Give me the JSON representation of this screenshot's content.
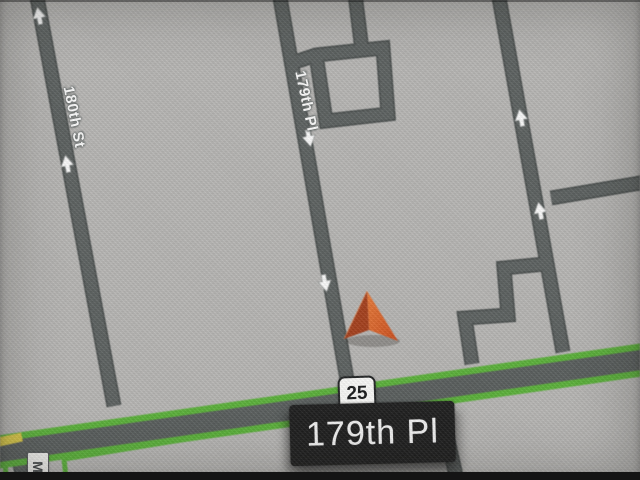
{
  "map": {
    "street_labels": {
      "street_180": "180th St",
      "street_179_vertical": "179th Pl",
      "street_m_partial": "M"
    },
    "route_shield_number": "25",
    "current_street_banner": "179th Pl",
    "oneway_arrows": [
      {
        "road": "180th St",
        "direction": "up"
      },
      {
        "road": "180th St",
        "direction": "up"
      },
      {
        "road": "179th Pl",
        "direction": "down"
      },
      {
        "road": "179th Pl",
        "direction": "down"
      },
      {
        "road": "right unnamed road",
        "direction": "up"
      },
      {
        "road": "right unnamed road",
        "direction": "up"
      }
    ],
    "colors": {
      "background": "#b7b6b4",
      "minor_road": "#5a5f5e",
      "minor_road_casing": "#484d4c",
      "highway_fill": "#575c5b",
      "highway_casing_green": "#55b231",
      "yellow_road_stub": "#dcc93e",
      "banner_background": "#1a1a1a",
      "banner_text": "#f4f4f4",
      "shield_background": "#fbfbf9",
      "marker_bright": "#e45c20",
      "marker_dark": "#a83b15"
    }
  }
}
